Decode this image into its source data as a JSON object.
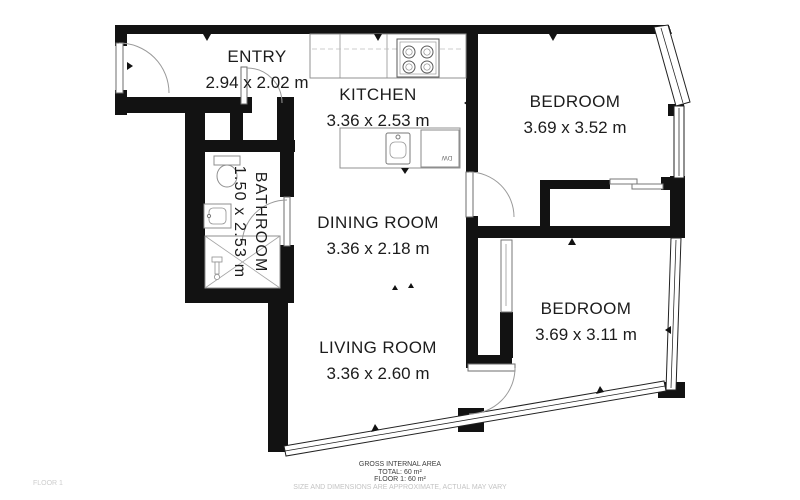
{
  "plan": {
    "rooms": {
      "entry": {
        "name": "ENTRY",
        "dims": "2.94 x 2.02 m"
      },
      "kitchen": {
        "name": "KITCHEN",
        "dims": "3.36 x 2.53 m"
      },
      "bedroom_top": {
        "name": "BEDROOM",
        "dims": "3.69 x 3.52 m"
      },
      "bathroom": {
        "name": "BATHROOM",
        "dims": "1.50 x 2.53 m"
      },
      "dining": {
        "name": "DINING ROOM",
        "dims": "3.36 x 2.18 m"
      },
      "living": {
        "name": "LIVING ROOM",
        "dims": "3.36 x 2.60 m"
      },
      "bedroom_bottom": {
        "name": "BEDROOM",
        "dims": "3.69 x 3.11 m"
      }
    },
    "labels": {
      "dishwasher": "DW"
    },
    "colors": {
      "wall": "#121212",
      "fixture_outline": "#919191",
      "text": "#1c1c1c",
      "muted": "#c3c3c3"
    }
  },
  "footer": {
    "area_title": "GROSS INTERNAL AREA",
    "total": "TOTAL: 60 m²",
    "floor": "FLOOR 1: 60 m²",
    "disclaimer": "SIZE AND DIMENSIONS ARE APPROXIMATE, ACTUAL MAY VARY"
  },
  "floor_label": "FLOOR 1"
}
